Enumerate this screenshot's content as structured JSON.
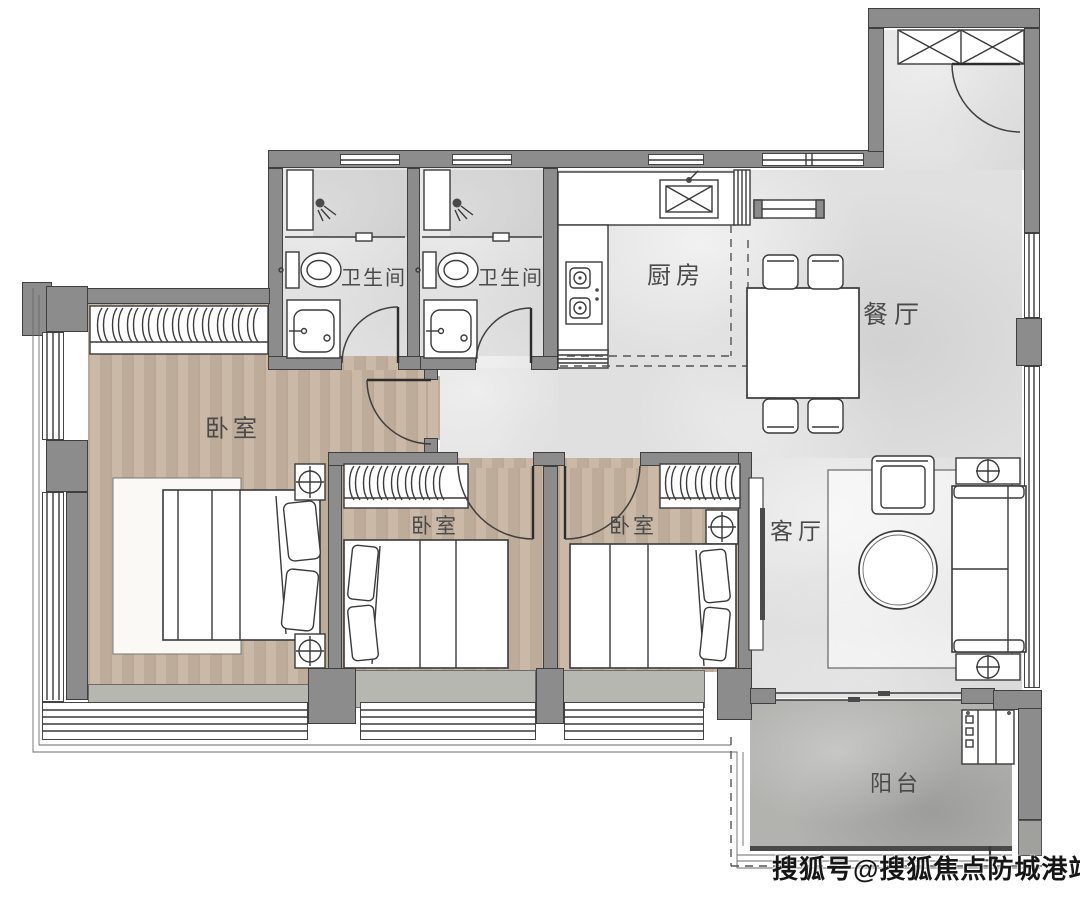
{
  "image_type": "apartment-floor-plan",
  "watermark": "搜狐号@搜狐焦点防城港站",
  "rooms": [
    {
      "id": "bathroom-1",
      "label": "卫生间"
    },
    {
      "id": "bathroom-2",
      "label": "卫生间"
    },
    {
      "id": "kitchen",
      "label": "厨房"
    },
    {
      "id": "dining-room",
      "label": "餐厅"
    },
    {
      "id": "master-bedroom",
      "label": "卧室"
    },
    {
      "id": "bedroom-2",
      "label": "卧室"
    },
    {
      "id": "bedroom-3",
      "label": "卧室"
    },
    {
      "id": "living-room",
      "label": "客厅"
    },
    {
      "id": "balcony",
      "label": "阳台"
    }
  ],
  "colors": {
    "wall": "#8c8c8c",
    "tile_floor": "#e0e0e0",
    "wood_floor": "#c7b5a2",
    "balcony_floor": "#b2b2af",
    "outline": "#3a3a3a",
    "label_text": "#4a4a4a"
  }
}
